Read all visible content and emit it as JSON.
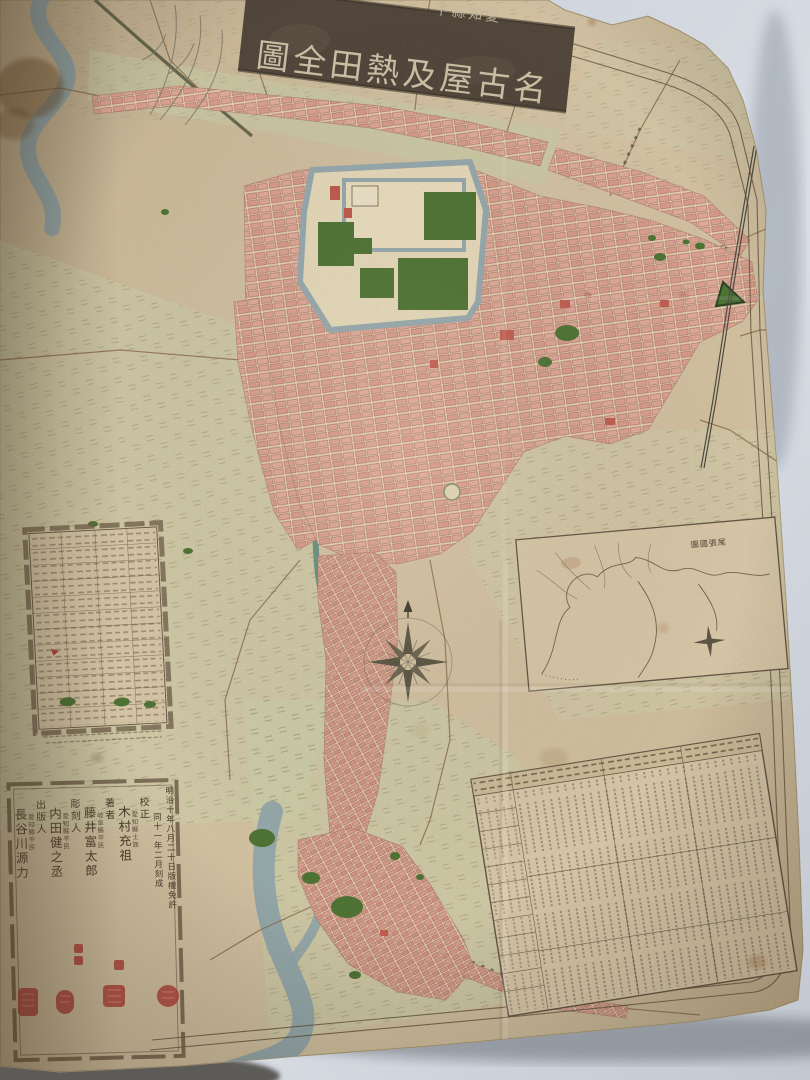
{
  "photo_description": "Photograph of a Meiji-era folded paper map of Nagoya and Atsuta, Aichi Prefecture",
  "banner": {
    "prefix": "愛知縣下",
    "title": "名古屋及熱田全圖"
  },
  "inset": {
    "title": "尾張國圖"
  },
  "colophon": {
    "license_line": "明治十年八月二十日版權免許",
    "publish_line": "同十一年二月刻成",
    "entries": [
      {
        "role": "校正",
        "affiliation": "愛知縣士族",
        "name": "木村充祖"
      },
      {
        "role": "著者",
        "affiliation": "岐阜縣平民",
        "name": "藤井富太郎"
      },
      {
        "role": "彫刻人",
        "affiliation": "愛知縣平民",
        "name": "内田健之丞"
      },
      {
        "role": "出版人",
        "affiliation": "愛知縣平民",
        "name": "長谷川源力"
      }
    ]
  },
  "colors": {
    "background": "#ccd3db",
    "paper": "#d3c2a1",
    "water": "#8fa6ad",
    "canal": "#5d8c80",
    "park_green": "#47702f",
    "block_pink": "#dda193",
    "seal_red": "#b23c36",
    "banner_board": "#4b4036",
    "ink": "#4a3a2a"
  }
}
